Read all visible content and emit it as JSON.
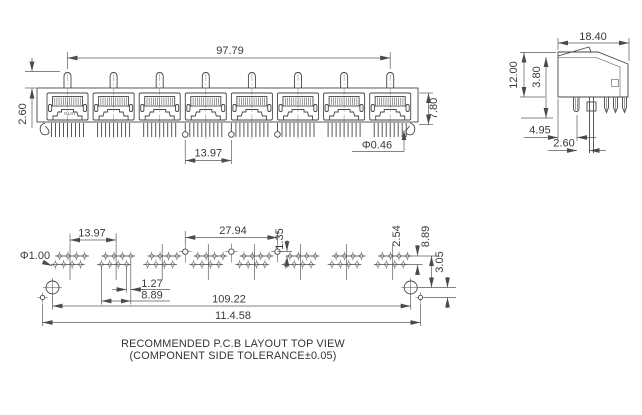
{
  "drawing": {
    "background": "#ffffff",
    "line_color": "#464646"
  },
  "front_view": {
    "name": "8-port RJ45 jack front view",
    "port_count": 8,
    "logo": "GLGI",
    "dims": {
      "overall_width": "97.79",
      "latch_height": "2.60",
      "port_height": "7.80",
      "port_pitch": "13.97",
      "pin_diameter": "Φ0.46"
    }
  },
  "side_view": {
    "name": "side view",
    "dims": {
      "depth": "18.40",
      "height": "12.00",
      "inner_height": "3.80",
      "pin_offset_a": "4.95",
      "pin_offset_b": "2.60"
    }
  },
  "pcb_view": {
    "name": "recommended PCB layout top view",
    "cluster_count": 8,
    "pins_per_cluster": 8,
    "dims": {
      "cluster_pitch": "13.97",
      "post_pitch": "27.94",
      "post_row_offset": "1.35",
      "hole_diameter": "Φ1.00",
      "pin_stagger": "1.27",
      "cluster_width": "8.89",
      "row_pitch": "2.54",
      "mount_row_offset": "8.89",
      "aux_hole_offset": "3.05",
      "mount_hole_span": "109.22",
      "overall_span": "11.4.58"
    }
  },
  "caption": {
    "line1": "RECOMMENDED P.C.B LAYOUT TOP VIEW",
    "line2": "(COMPONENT SIDE TOLERANCE±0.05)"
  }
}
